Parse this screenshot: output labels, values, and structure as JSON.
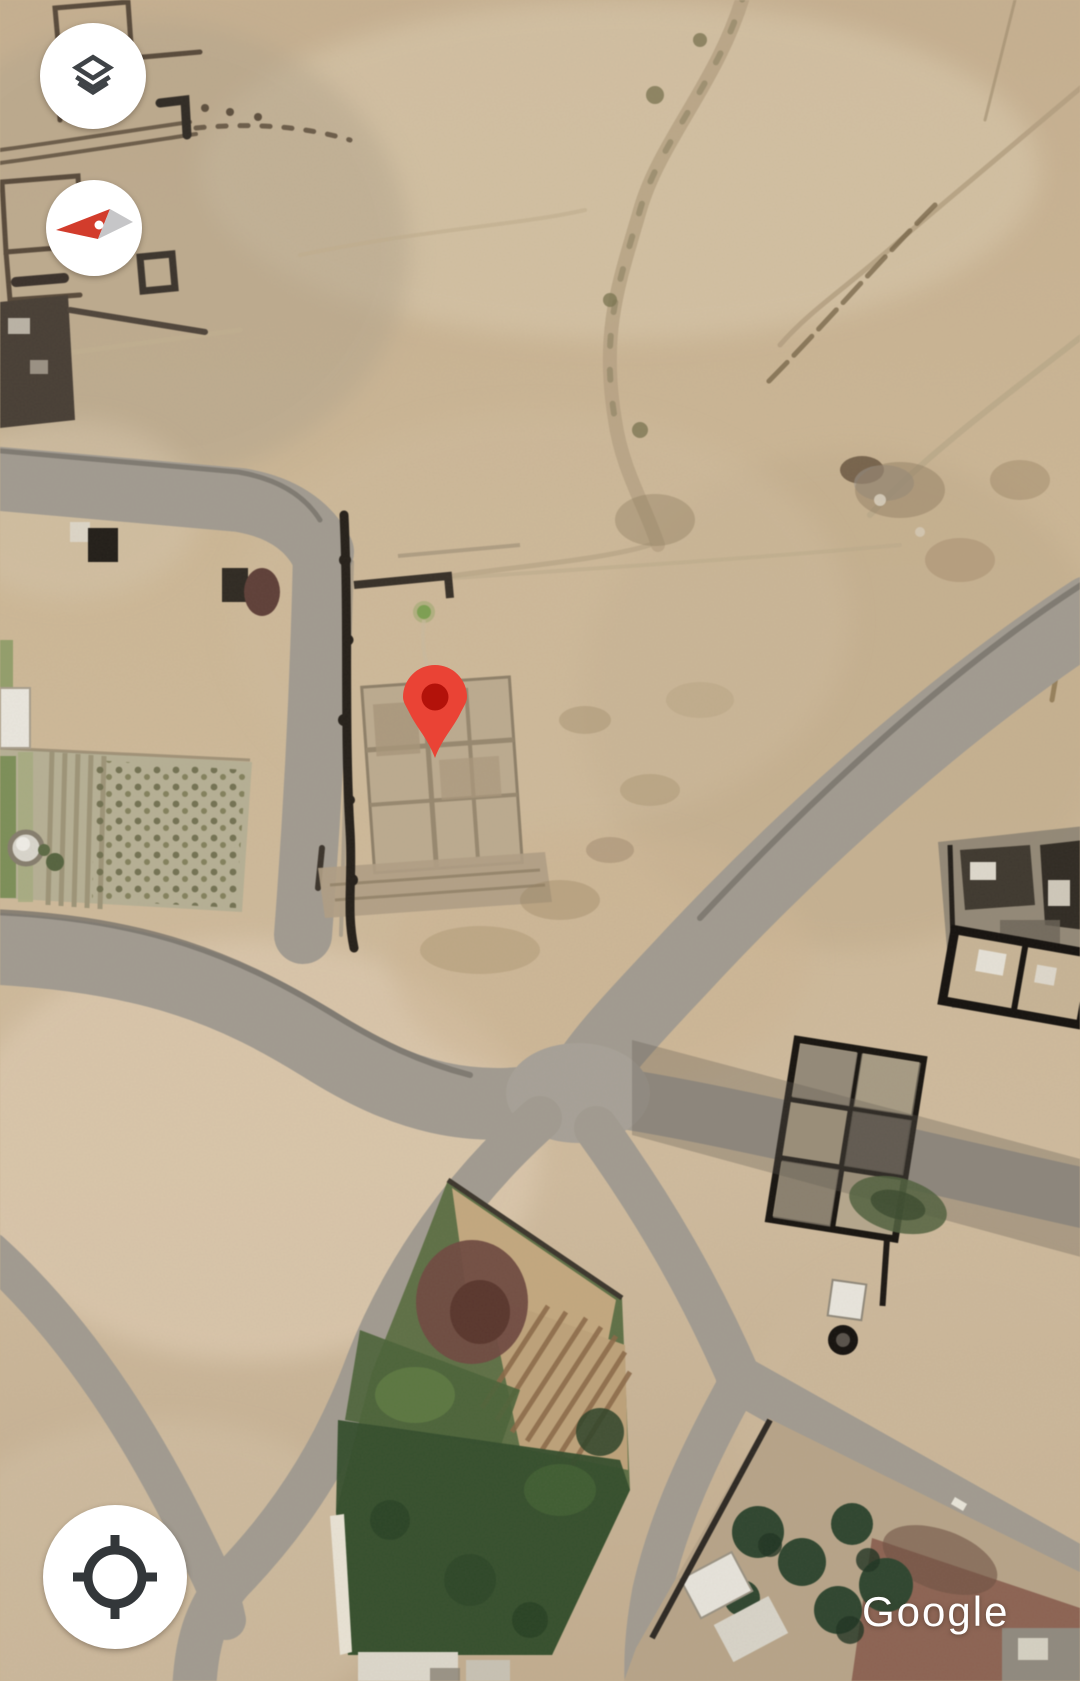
{
  "map": {
    "view_type": "satellite",
    "attribution": "Google",
    "marker": {
      "icon": "map-pin-icon",
      "color": "#ea4335",
      "inner_color": "#b3120a"
    }
  },
  "controls": {
    "layers_button": {
      "icon": "layers-icon",
      "icon_color": "#3f4347",
      "bg": "#ffffff"
    },
    "compass_button": {
      "icon": "compass-icon",
      "north_color": "#d23c2c",
      "south_color": "#c6c6c8",
      "bg": "#ffffff"
    },
    "my_location_button": {
      "icon": "my-location-icon",
      "icon_color": "#33373a",
      "bg": "#ffffff"
    }
  },
  "palette": {
    "sand": "#cbb596",
    "road": "#a19b91",
    "vegetation": "#3f5a38",
    "watermark_text": "#ffffff"
  }
}
